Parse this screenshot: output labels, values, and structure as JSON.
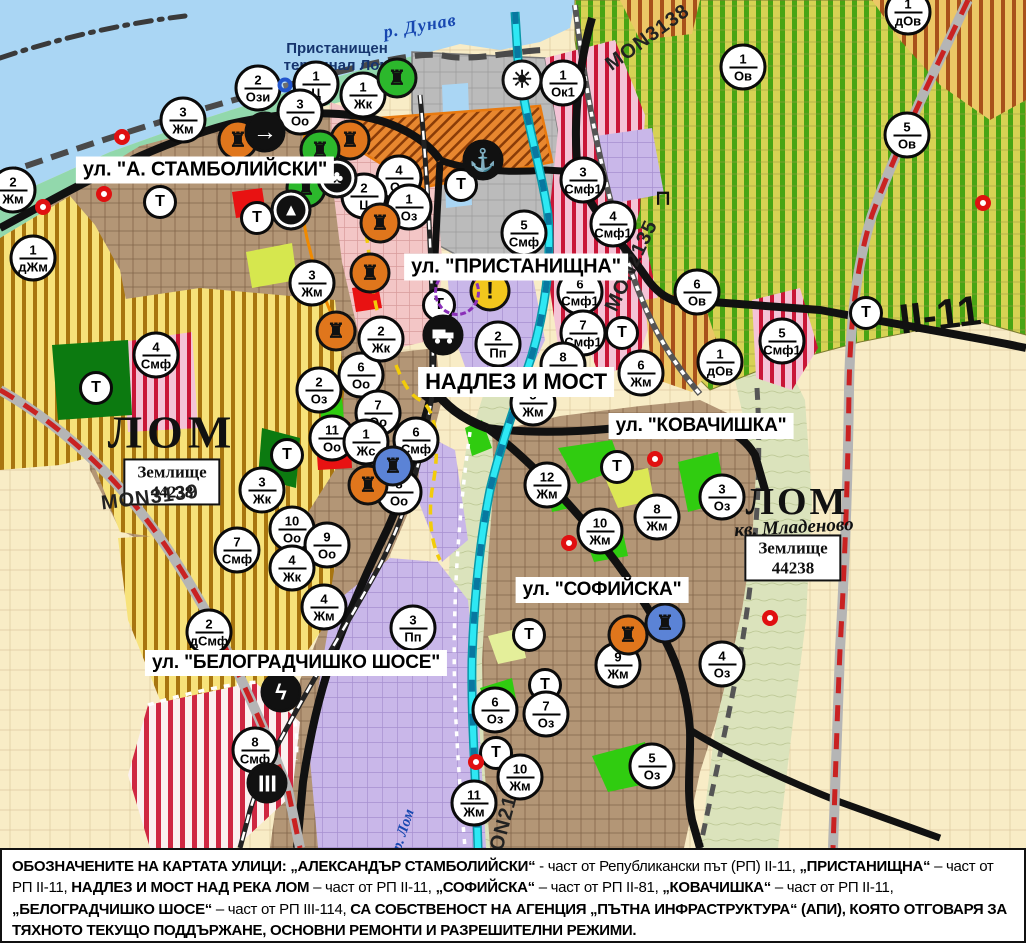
{
  "map": {
    "width": 1026,
    "height": 848,
    "street_labels": [
      {
        "text": "ул. \"А. СТАМБОЛИЙСКИ\"",
        "x": 205,
        "y": 170,
        "fs": 20
      },
      {
        "text": "ул. \"ПРИСТАНИЩНА\"",
        "x": 516,
        "y": 267,
        "fs": 20
      },
      {
        "text": "НАДЛЕЗ И МОСТ",
        "x": 516,
        "y": 382,
        "fs": 22
      },
      {
        "text": "ул. \"КОВАЧИШКА\"",
        "x": 701,
        "y": 426,
        "fs": 19
      },
      {
        "text": "ул. \"СОФИЙСКА\"",
        "x": 602,
        "y": 590,
        "fs": 19
      },
      {
        "text": "ул. \"БЕЛОГРАДЧИШКО ШОСЕ\"",
        "x": 296,
        "y": 663,
        "fs": 19
      }
    ],
    "area_labels": [
      {
        "text": "р. Дунав",
        "x": 420,
        "y": 26,
        "rot": -10,
        "cls": "river-label"
      },
      {
        "text": "Пристанищен\nтерминал Лом",
        "x": 337,
        "y": 57,
        "rot": 0,
        "cls": "port-label"
      },
      {
        "text": "ЛОМ",
        "x": 172,
        "y": 432,
        "rot": 0,
        "cls": "city-label"
      },
      {
        "text": "Землище\n44238",
        "x": 172,
        "y": 482,
        "rot": 0,
        "cls": "zem-box"
      },
      {
        "text": "MON3139",
        "x": 150,
        "y": 498,
        "rot": -7,
        "cls": "mon-label"
      },
      {
        "text": "ЛОМ",
        "x": 797,
        "y": 502,
        "rot": 0,
        "cls": "city-label small"
      },
      {
        "text": "кв. Младеново",
        "x": 794,
        "y": 528,
        "rot": -3,
        "cls": "kv-label"
      },
      {
        "text": "Землище\n44238",
        "x": 793,
        "y": 558,
        "rot": 0,
        "cls": "zem-box"
      },
      {
        "text": "MON3138",
        "x": 648,
        "y": 38,
        "rot": -36,
        "cls": "mon-label"
      },
      {
        "text": "MON2135",
        "x": 632,
        "y": 266,
        "rot": -65,
        "cls": "mon-label"
      },
      {
        "text": "MON2136",
        "x": 505,
        "y": 820,
        "rot": -75,
        "cls": "mon-label"
      },
      {
        "text": "II-11",
        "x": 940,
        "y": 315,
        "rot": -7,
        "cls": "road-num"
      },
      {
        "text": "р. Лом",
        "x": 404,
        "y": 830,
        "rot": -72,
        "cls": "lom-river-label"
      }
    ],
    "t_label": "Т",
    "t_markers": [
      {
        "x": 160,
        "y": 202
      },
      {
        "x": 257,
        "y": 218
      },
      {
        "x": 96,
        "y": 388
      },
      {
        "x": 287,
        "y": 455
      },
      {
        "x": 461,
        "y": 185
      },
      {
        "x": 439,
        "y": 305
      },
      {
        "x": 622,
        "y": 333
      },
      {
        "x": 866,
        "y": 313
      },
      {
        "x": 617,
        "y": 467
      },
      {
        "x": 529,
        "y": 635
      },
      {
        "x": 545,
        "y": 685
      },
      {
        "x": 496,
        "y": 753
      }
    ],
    "zone_markers": [
      {
        "n": "2",
        "c": "Ози",
        "x": 258,
        "y": 88
      },
      {
        "n": "1",
        "c": "Ц",
        "x": 316,
        "y": 84
      },
      {
        "n": "1",
        "c": "Жк",
        "x": 363,
        "y": 95
      },
      {
        "n": "3",
        "c": "Оо",
        "x": 300,
        "y": 112
      },
      {
        "n": "3",
        "c": "Жм",
        "x": 183,
        "y": 120
      },
      {
        "n": "2",
        "c": "Жм",
        "x": 13,
        "y": 190
      },
      {
        "n": "1",
        "c": "дЖм",
        "x": 33,
        "y": 258
      },
      {
        "n": "3",
        "c": "Жм",
        "x": 312,
        "y": 283
      },
      {
        "n": "4",
        "c": "Оо",
        "x": 399,
        "y": 178
      },
      {
        "n": "2",
        "c": "Ц",
        "x": 364,
        "y": 196
      },
      {
        "n": "1",
        "c": "Оз",
        "x": 409,
        "y": 207
      },
      {
        "n": "1",
        "c": "Ок1",
        "x": 563,
        "y": 83
      },
      {
        "n": "3",
        "c": "Смф1",
        "x": 583,
        "y": 180
      },
      {
        "n": "5",
        "c": "Смф",
        "x": 524,
        "y": 233
      },
      {
        "n": "4",
        "c": "Смф1",
        "x": 613,
        "y": 224
      },
      {
        "n": "1",
        "c": "Ов",
        "x": 743,
        "y": 67
      },
      {
        "n": "1",
        "c": "дОв",
        "x": 908,
        "y": 12
      },
      {
        "n": "5",
        "c": "Ов",
        "x": 907,
        "y": 135
      },
      {
        "n": "6",
        "c": "Ов",
        "x": 697,
        "y": 292
      },
      {
        "n": "5",
        "c": "Смф1",
        "x": 782,
        "y": 341
      },
      {
        "n": "1",
        "c": "дОв",
        "x": 720,
        "y": 362
      },
      {
        "n": "6",
        "c": "Жм",
        "x": 641,
        "y": 373
      },
      {
        "n": "6",
        "c": "Смф1",
        "x": 580,
        "y": 292
      },
      {
        "n": "7",
        "c": "Смф1",
        "x": 583,
        "y": 333
      },
      {
        "n": "2",
        "c": "Пп",
        "x": 498,
        "y": 344
      },
      {
        "n": "8",
        "c": "Жм",
        "x": 563,
        "y": 365
      },
      {
        "n": "5",
        "c": "Жм",
        "x": 533,
        "y": 403
      },
      {
        "n": "12",
        "c": "Жм",
        "x": 547,
        "y": 485
      },
      {
        "n": "10",
        "c": "Жм",
        "x": 600,
        "y": 531
      },
      {
        "n": "8",
        "c": "Жм",
        "x": 657,
        "y": 517
      },
      {
        "n": "3",
        "c": "Оз",
        "x": 722,
        "y": 497
      },
      {
        "n": "9",
        "c": "Жм",
        "x": 618,
        "y": 665
      },
      {
        "n": "7",
        "c": "Оз",
        "x": 546,
        "y": 714
      },
      {
        "n": "6",
        "c": "Оз",
        "x": 495,
        "y": 710
      },
      {
        "n": "10",
        "c": "Жм",
        "x": 520,
        "y": 777
      },
      {
        "n": "11",
        "c": "Жм",
        "x": 474,
        "y": 803
      },
      {
        "n": "5",
        "c": "Оз",
        "x": 652,
        "y": 766
      },
      {
        "n": "4",
        "c": "Оз",
        "x": 722,
        "y": 664
      },
      {
        "n": "10",
        "c": "Оо",
        "x": 292,
        "y": 529
      },
      {
        "n": "9",
        "c": "Оо",
        "x": 327,
        "y": 545
      },
      {
        "n": "7",
        "c": "Смф",
        "x": 237,
        "y": 550
      },
      {
        "n": "4",
        "c": "Жк",
        "x": 292,
        "y": 568
      },
      {
        "n": "4",
        "c": "Жм",
        "x": 324,
        "y": 607
      },
      {
        "n": "2",
        "c": "дСмф",
        "x": 209,
        "y": 632
      },
      {
        "n": "3",
        "c": "Пп",
        "x": 413,
        "y": 628
      },
      {
        "n": "8",
        "c": "Смф",
        "x": 255,
        "y": 750
      },
      {
        "n": "4",
        "c": "Смф",
        "x": 156,
        "y": 355
      },
      {
        "n": "11",
        "c": "Оо",
        "x": 332,
        "y": 438
      },
      {
        "n": "2",
        "c": "Оз",
        "x": 319,
        "y": 390
      },
      {
        "n": "6",
        "c": "Оо",
        "x": 361,
        "y": 375
      },
      {
        "n": "7",
        "c": "Оо",
        "x": 378,
        "y": 413
      },
      {
        "n": "2",
        "c": "Жк",
        "x": 381,
        "y": 339
      },
      {
        "n": "1",
        "c": "Жс",
        "x": 366,
        "y": 442
      },
      {
        "n": "6",
        "c": "Смф",
        "x": 416,
        "y": 440
      },
      {
        "n": "8",
        "c": "Оо",
        "x": 399,
        "y": 492
      },
      {
        "n": "3",
        "c": "Жк",
        "x": 262,
        "y": 490
      }
    ],
    "icon_markers": [
      {
        "t": "culture-orange",
        "x": 238,
        "y": 140
      },
      {
        "t": "culture-orange",
        "x": 350,
        "y": 140
      },
      {
        "t": "culture-orange",
        "x": 380,
        "y": 223
      },
      {
        "t": "culture-orange",
        "x": 370,
        "y": 273
      },
      {
        "t": "culture-orange",
        "x": 336,
        "y": 331
      },
      {
        "t": "culture-orange",
        "x": 368,
        "y": 485
      },
      {
        "t": "culture-orange",
        "x": 628,
        "y": 635
      },
      {
        "t": "culture-green",
        "x": 397,
        "y": 78
      },
      {
        "t": "culture-green",
        "x": 320,
        "y": 150
      },
      {
        "t": "culture-green",
        "x": 306,
        "y": 188
      },
      {
        "t": "culture-blue",
        "x": 393,
        "y": 466
      },
      {
        "t": "culture-blue",
        "x": 665,
        "y": 623
      },
      {
        "t": "one-way-arrow",
        "x": 265,
        "y": 132
      },
      {
        "t": "monument-club",
        "x": 337,
        "y": 178
      },
      {
        "t": "monument-triangle",
        "x": 291,
        "y": 210
      },
      {
        "t": "anchor",
        "x": 483,
        "y": 160
      },
      {
        "t": "fan",
        "x": 522,
        "y": 80
      },
      {
        "t": "truck",
        "x": 443,
        "y": 335
      },
      {
        "t": "warning",
        "x": 490,
        "y": 291
      },
      {
        "t": "lightning",
        "x": 281,
        "y": 692
      },
      {
        "t": "railcross",
        "x": 267,
        "y": 783
      },
      {
        "t": "reddot",
        "x": 122,
        "y": 137
      },
      {
        "t": "reddot",
        "x": 104,
        "y": 194
      },
      {
        "t": "reddot",
        "x": 43,
        "y": 207
      },
      {
        "t": "reddot",
        "x": 655,
        "y": 459
      },
      {
        "t": "reddot",
        "x": 569,
        "y": 543
      },
      {
        "t": "reddot",
        "x": 476,
        "y": 762
      },
      {
        "t": "reddot",
        "x": 983,
        "y": 203
      },
      {
        "t": "reddot",
        "x": 770,
        "y": 618
      },
      {
        "t": "bluering",
        "x": 285,
        "y": 85
      },
      {
        "t": "purple-ellipse",
        "x": 457,
        "y": 292
      },
      {
        "t": "bridge",
        "x": 663,
        "y": 198
      }
    ]
  },
  "colors": {
    "water": "#aad6f4",
    "shore_green": "#92d8ac",
    "port_gray": "#bbbbbb",
    "urban_brown": "#b39676",
    "farm_cream": "#f8ecc6",
    "lavender": "#c9b7e9",
    "yellow_zone": "#f7e27a",
    "stripe_brown": "#a8750f",
    "vineyard": "#d7d254",
    "stripe_green": "#49a414",
    "pink_zone": "#f4c3d6",
    "stripe_red": "#c91637",
    "dark_green": "#0c7a10",
    "bright_green": "#30cc10",
    "solid_red": "#e81212",
    "road_black": "#111111",
    "road_red_dash": "#c92222",
    "river_cyan": "#2ee8f4",
    "marker_orange": "#e0761c",
    "marker_green": "#2cb82c",
    "marker_blue": "#5b83d6",
    "warning_yellow": "#f2c71d"
  },
  "legend": {
    "segments": [
      {
        "b": true,
        "text": "ОБОЗНАЧЕНИТЕ НА КАРТАТА УЛИЦИ: „АЛЕКСАНДЪР СТАМБОЛИЙСКИ“"
      },
      {
        "b": false,
        "text": " - част от Републикански път (РП) II-11, "
      },
      {
        "b": true,
        "text": "„ПРИСТАНИЩНА“"
      },
      {
        "b": false,
        "text": " – част от РП II-11, "
      },
      {
        "b": true,
        "text": "НАДЛЕЗ И МОСТ НАД РЕКА ЛОМ"
      },
      {
        "b": false,
        "text": " – част от РП II-11, "
      },
      {
        "b": true,
        "text": "„СОФИЙСКА“"
      },
      {
        "b": false,
        "text": " – част от РП II-81, "
      },
      {
        "b": true,
        "text": "„КОВАЧИШКА“"
      },
      {
        "b": false,
        "text": " – част от РП II-11, "
      },
      {
        "b": true,
        "text": "„БЕЛОГРАДЧИШКО ШОСЕ“"
      },
      {
        "b": false,
        "text": " – част от РП III-114, "
      },
      {
        "b": true,
        "text": "СА СОБСТВЕНОСТ НА АГЕНЦИЯ „ПЪТНА ИНФРАСТРУКТУРА“ (АПИ), КОЯТО ОТГОВАРЯ ЗА ТЯХНОТО ТЕКУЩО ПОДДЪРЖАНЕ, ОСНОВНИ РЕМОНТИ И РАЗРЕШИТЕЛНИ РЕЖИМИ."
      }
    ]
  }
}
